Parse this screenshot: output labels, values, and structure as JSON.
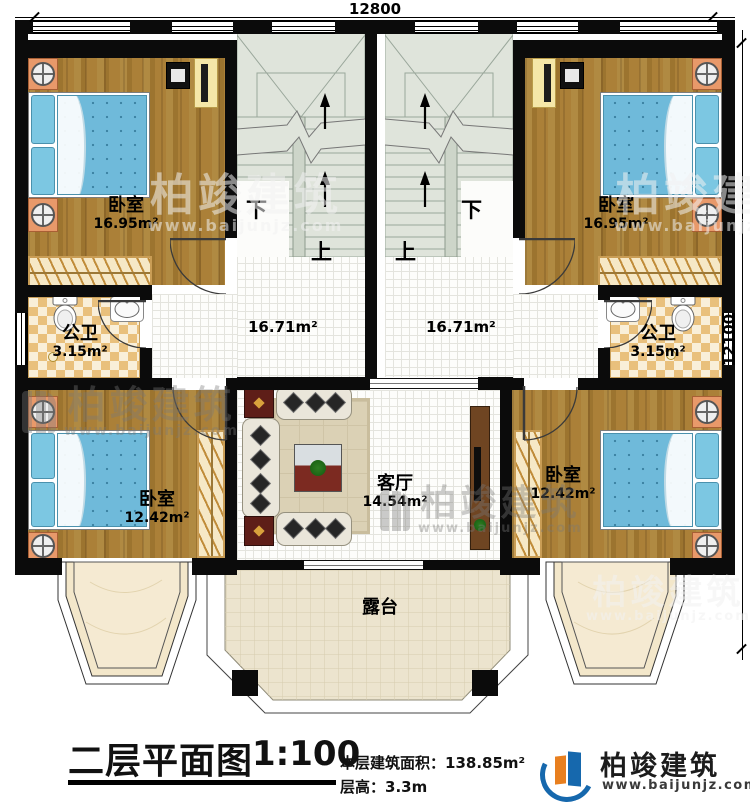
{
  "dimensions": {
    "top": "12800",
    "right": "12100"
  },
  "stairs": {
    "down": "下",
    "up": "上"
  },
  "rooms": {
    "bedroom_tl": {
      "name": "卧室",
      "area": "16.95m²"
    },
    "bedroom_tr": {
      "name": "卧室",
      "area": "16.95m²"
    },
    "bedroom_bl": {
      "name": "卧室",
      "area": "12.42m²"
    },
    "bedroom_br": {
      "name": "卧室",
      "area": "12.42m²"
    },
    "bath_l": {
      "name": "公卫",
      "area": "3.15m²"
    },
    "bath_r": {
      "name": "公卫",
      "area": "3.15m²"
    },
    "hall_l": {
      "area": "16.71m²"
    },
    "hall_r": {
      "area": "16.71m²"
    },
    "living": {
      "name": "客厅",
      "area": "14.54m²"
    },
    "terrace": {
      "name": "露台"
    }
  },
  "titleblock": {
    "title": "二层平面图",
    "scale": "1:100",
    "area_label": "本层建筑面积：",
    "area_value": "138.85m²",
    "floor_height_label": "层高：",
    "floor_height_value": "3.3m"
  },
  "brand": {
    "name": "柏竣建筑",
    "website": "www.baijunjz.com"
  },
  "watermark": {
    "name": "柏竣建筑",
    "website": "www.baijunjz.com"
  },
  "colors": {
    "wall": "#0b0b0b",
    "wood_floor": "#a87c33",
    "stair": "#dfe4db",
    "bath_tile": "#e9c07c",
    "terrace_tile": "#ece4ce",
    "bed_blue": "#6fbada",
    "nightstand_orange": "#e8996a",
    "brand_blue": "#1668ad",
    "brand_orange": "#e87f1f"
  }
}
